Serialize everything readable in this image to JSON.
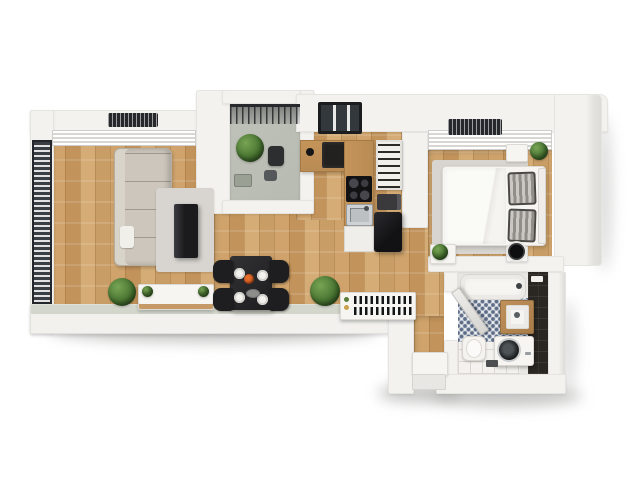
{
  "scene": {
    "description": "Top-down 3D rendering of a furnished one-bedroom apartment floor plan with white walls and wooden floors on a plain white background",
    "style": "photorealistic 3D floor plan render",
    "visible_text": ""
  },
  "palette": {
    "background": "#ffffff",
    "wall": "#f3f2ef",
    "wall-face": "#dedcd8",
    "sill": "#d3d6cb",
    "wood": "#c99e66",
    "wood-dark": "#b98c55",
    "concrete": "#b8bbb2",
    "rug": "#d8d5d0",
    "sofa": "#ccc6bc",
    "steel": "#bdc0c2",
    "white-soft": "#f6f5f2",
    "green": "#2f5423",
    "orange": "#d2571d",
    "mosaic-blue": "#5e6e88",
    "tile-white": "#f3f2ee",
    "black-tile": "#2a2622",
    "grout": "#dbd7d1"
  },
  "rooms": [
    {
      "name": "Living room",
      "furniture": [
        "window with white blinds",
        "corner sofa",
        "TV unit",
        "gray area rug",
        "white sideboard",
        "potted plants",
        "air vent grille"
      ]
    },
    {
      "name": "Balcony",
      "furniture": [
        "dark metal railing",
        "potted tree",
        "outdoor chair",
        "small table",
        "planter box"
      ]
    },
    {
      "name": "Kitchen",
      "furniture": [
        "dark skylight window",
        "wooden countertop",
        "dark built-in cabinet",
        "cooktop with 4 burners",
        "stainless sink",
        "ladder shelf",
        "microwave oven",
        "black refrigerator"
      ]
    },
    {
      "name": "Dining area",
      "furniture": [
        "black dining table",
        "black chairs",
        "white plates",
        "orange fruit bowl",
        "gray serving tray",
        "bottle rack cabinet",
        "potted plant"
      ]
    },
    {
      "name": "Bedroom",
      "furniture": [
        "double bed with white duvet",
        "striped gray pillows",
        "white nightstands",
        "black table fan",
        "potted plants",
        "gray area rug",
        "window blinds",
        "air-conditioner grille",
        "small dresser"
      ]
    },
    {
      "name": "Bathroom",
      "furniture": [
        "bathtub",
        "wooden vanity with sink",
        "washing machine",
        "toilet",
        "floor drain",
        "open door",
        "black tiled wall",
        "blue patterned mosaic floor",
        "white tiled shower floor"
      ]
    },
    {
      "name": "Entry hall",
      "furniture": [
        "white door mat",
        "entry threshold",
        "corridor"
      ]
    }
  ],
  "counts": {
    "dining_chairs": 4,
    "dining_plates": 4,
    "cooktop_burners": 4,
    "bed_pillows": 2,
    "nightstands": 2,
    "bottle_rack_rows": 2
  }
}
